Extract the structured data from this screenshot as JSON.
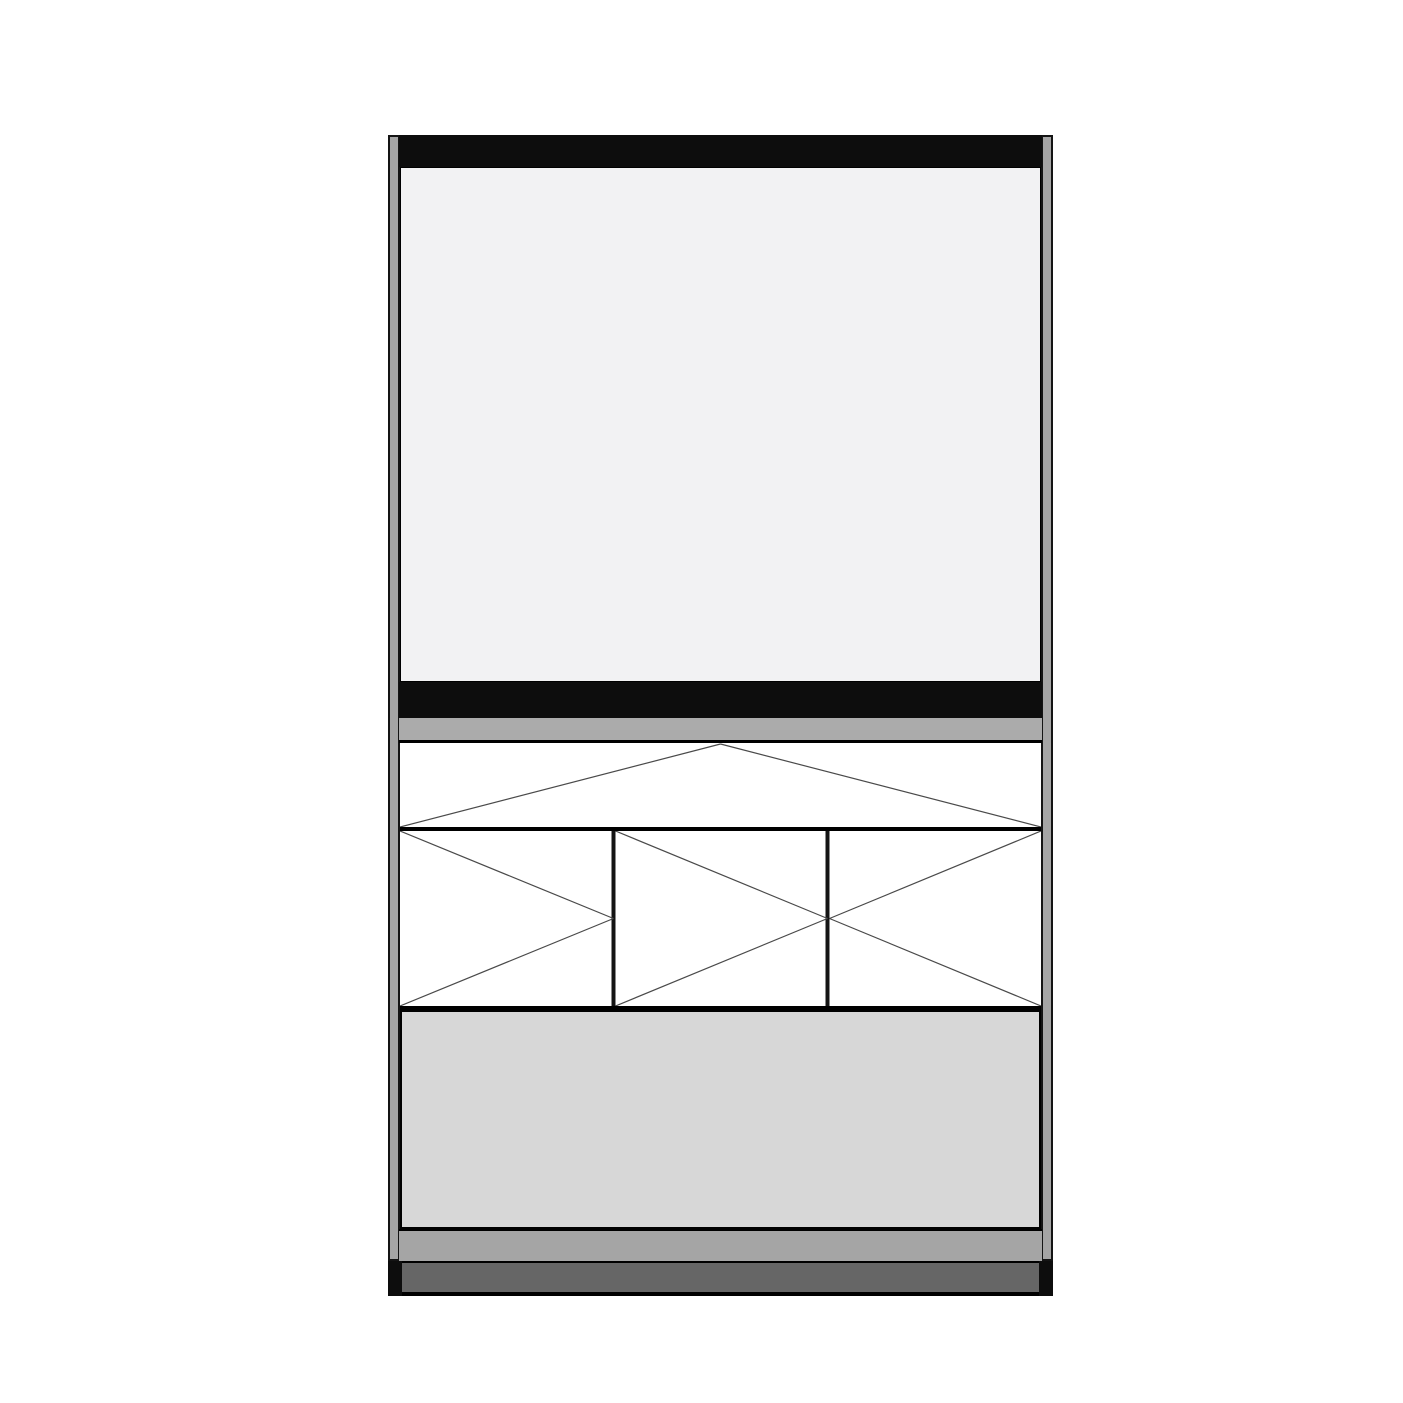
{
  "drawing": {
    "type": "furniture-cabinet-elevation",
    "description": "Front elevation line drawing of a tall cabinet: dark cornice bar, large light upper panel, second dark bar, shelf strip, top flap door with downward swing symbol, three hinged door panels with V swing symbols, plain lower panel, and a recessed plinth with dark feet.",
    "door_panel_count": 3,
    "swing_symbols": {
      "flap_band": "triangle-apex-top-center-swing-symbol",
      "left_door": "v-open-left-swing-symbol",
      "middle_door": "v-open-left-swing-symbol",
      "right_door": "v-open-right-swing-symbol"
    }
  },
  "colors": {
    "canvas": "#ffffff",
    "outline": "#141414",
    "bar": "#0d0d0d",
    "rail": "#a5a5a5",
    "upper_panel": "#f2f2f3",
    "upper_panel_border": "#8f8f8f",
    "shelf_strip": "#ababab",
    "band_bg": "#ffffff",
    "swing_line": "#4a4a4a",
    "lower_panel": "#d7d7d7",
    "bottom_strip": "#a5a5a5",
    "plinth": "#666666",
    "foot": "#0d0d0d"
  }
}
